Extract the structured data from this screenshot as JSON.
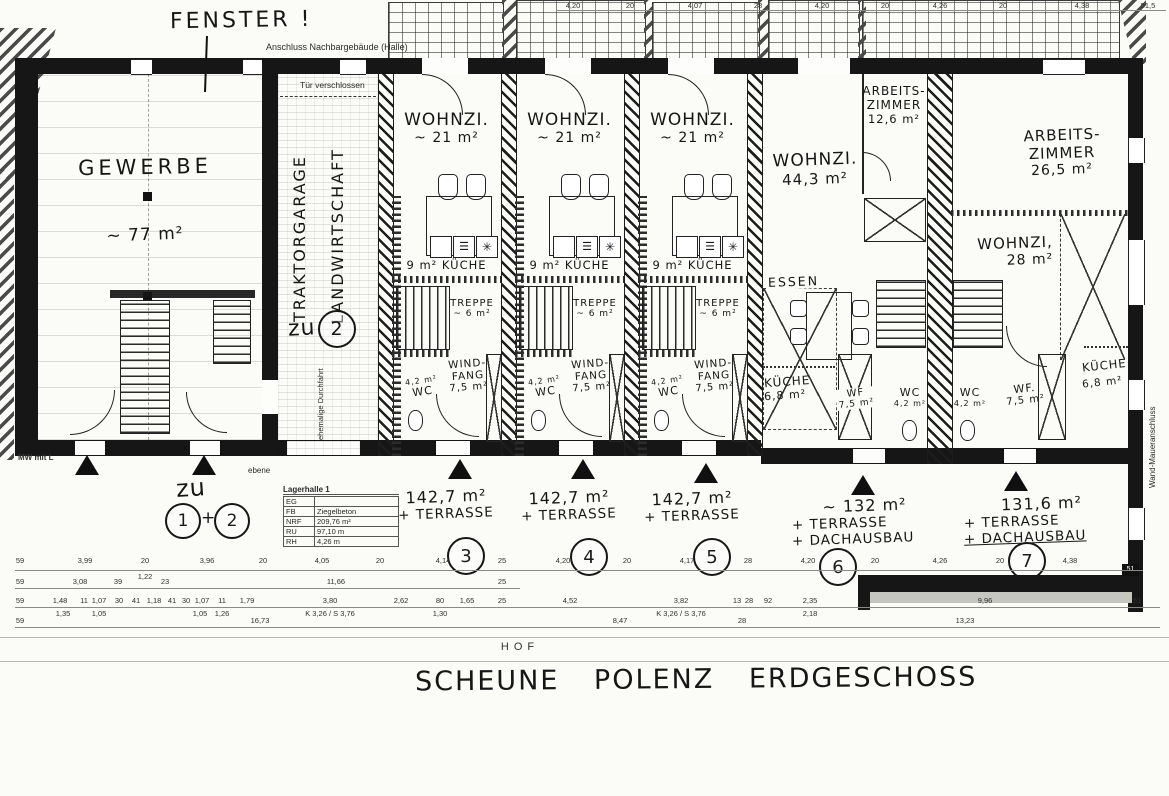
{
  "sheet": {
    "title": "SCHEUNE POLENZ ERDGESCHOSS",
    "hof": "HOF"
  },
  "notes": {
    "fenster": "FENSTER !",
    "anschluss": "Anschluss Nachbargebäude (Halle)",
    "tuer_verschlossen": "Tür verschlossen",
    "ehemalige_durchfahrt": "ehemalige Durchfahrt",
    "ebene": "ebene",
    "mw_mit_l": "MW mit L",
    "wand_maueranschluss": "Wand-Maueranschluss",
    "corner_51": "51"
  },
  "rooms": {
    "gewerbe": {
      "name": "GEWERBE",
      "area": "~ 77 m²"
    },
    "garage": {
      "line1": "TRAKTORGARAGE",
      "line2": "LANDWIRTSCHAFT",
      "zu": "zu",
      "zu_num": "2"
    },
    "rowhouse": {
      "wohnzi": "WOHNZI.",
      "wohnzi_area": "~ 21 m²",
      "kueche_area": "9 m²",
      "kueche": "KÜCHE",
      "treppe": "TREPPE",
      "treppe_area": "~ 6 m²",
      "wind": "WIND-",
      "fang": "FANG",
      "wf_area": "7,5 m²",
      "wc_area": "4,2 m²",
      "wc": "WC"
    },
    "unit6": {
      "wohnzi": "WOHNZI.",
      "wohnzi_area": "44,3 m²",
      "essen": "ESSEN",
      "kueche": "KÜCHE",
      "kueche_area": "6,8 m²",
      "az1": "ARBEITS-",
      "az2": "ZIMMER",
      "az_area": "12,6 m²",
      "wf": "WF",
      "wf_area": "7,5 m²",
      "wc": "WC",
      "wc_area": "4,2 m²"
    },
    "unit7": {
      "az1": "ARBEITS-",
      "az2": "ZIMMER",
      "az_area": "26,5 m²",
      "wohnzi": "WOHNZI,",
      "wohnzi_area": "28 m²",
      "wc": "WC",
      "wc_area": "4,2 m²",
      "wf": "WF.",
      "wf_area": "7,5 m²",
      "kueche": "KÜCHE",
      "kueche_area": "6,8 m²"
    }
  },
  "tags": {
    "entrance12": {
      "zu": "zu",
      "n1": "1",
      "plus": "+",
      "n2": "2"
    },
    "u3": {
      "area": "142,7 m²",
      "l2": "+ TERRASSE",
      "num": "3"
    },
    "u4": {
      "area": "142,7 m²",
      "l2": "+ TERRASSE",
      "num": "4"
    },
    "u5": {
      "area": "142,7 m²",
      "l2": "+ TERRASSE",
      "num": "5"
    },
    "u6": {
      "area": "~ 132  m²",
      "l2": "+ TERRASSE",
      "l3": "+ DACHAUSBAU",
      "num": "6"
    },
    "u7": {
      "area": "131,6 m²",
      "l2": "+ TERRASSE",
      "l3": "+ DACHAUSBAU",
      "num": "7"
    }
  },
  "lagerhalle": {
    "title": "Lagerhalle 1",
    "rows": [
      [
        "EG",
        ""
      ],
      [
        "FB",
        "Ziegelbeton"
      ],
      [
        "NRF",
        "209,76 m²"
      ],
      [
        "RU",
        "97,10 m"
      ],
      [
        "RH",
        "4,26 m"
      ]
    ]
  },
  "icons": {
    "stove": "✳",
    "oven": "☰"
  },
  "dims": {
    "lines": [
      {
        "y": 10,
        "x1": 556,
        "x2": 1166
      },
      {
        "y": 570,
        "x1": 15,
        "x2": 1143
      },
      {
        "y": 588,
        "x1": 15,
        "x2": 520
      },
      {
        "y": 607,
        "x1": 15,
        "x2": 1160
      },
      {
        "y": 627,
        "x1": 15,
        "x2": 1160
      }
    ],
    "groups": [
      {
        "y": 1,
        "items": [
          {
            "t": "4,20",
            "x": 573
          },
          {
            "t": "20",
            "x": 630
          },
          {
            "t": "4,07",
            "x": 695
          },
          {
            "t": "28",
            "x": 758
          },
          {
            "t": "4,20",
            "x": 822
          },
          {
            "t": "20",
            "x": 885
          },
          {
            "t": "4,26",
            "x": 940
          },
          {
            "t": "20",
            "x": 1003
          },
          {
            "t": "4,38",
            "x": 1082
          },
          {
            "t": "51,5",
            "x": 1148
          }
        ]
      },
      {
        "y": 556,
        "items": [
          {
            "t": "59",
            "x": 20
          },
          {
            "t": "3,99",
            "x": 85
          },
          {
            "t": "20",
            "x": 145
          },
          {
            "t": "3,96",
            "x": 207
          },
          {
            "t": "20",
            "x": 263
          },
          {
            "t": "4,05",
            "x": 322
          },
          {
            "t": "20",
            "x": 380
          },
          {
            "t": "4,14",
            "x": 443
          },
          {
            "t": "25",
            "x": 502
          },
          {
            "t": "4,20",
            "x": 563
          },
          {
            "t": "20",
            "x": 627
          },
          {
            "t": "4,17",
            "x": 687
          },
          {
            "t": "28",
            "x": 748
          },
          {
            "t": "4,20",
            "x": 808
          },
          {
            "t": "20",
            "x": 875
          },
          {
            "t": "4,26",
            "x": 940
          },
          {
            "t": "20",
            "x": 1000
          },
          {
            "t": "4,38",
            "x": 1070
          }
        ]
      },
      {
        "y": 572,
        "items": [
          {
            "t": "1,22",
            "x": 145
          }
        ]
      },
      {
        "y": 577,
        "items": [
          {
            "t": "59",
            "x": 20
          },
          {
            "t": "3,08",
            "x": 80
          },
          {
            "t": "39",
            "x": 118
          },
          {
            "t": "23",
            "x": 165
          },
          {
            "t": "11,66",
            "x": 336
          },
          {
            "t": "25",
            "x": 502
          }
        ]
      },
      {
        "y": 596,
        "items": [
          {
            "t": "59",
            "x": 20
          },
          {
            "t": "1,48",
            "x": 60
          },
          {
            "t": "11",
            "x": 84
          },
          {
            "t": "1,07",
            "x": 99
          },
          {
            "t": "30",
            "x": 119
          },
          {
            "t": "41",
            "x": 136
          },
          {
            "t": "1,18",
            "x": 154
          },
          {
            "t": "41",
            "x": 172
          },
          {
            "t": "30",
            "x": 186
          },
          {
            "t": "1,07",
            "x": 202
          },
          {
            "t": "11",
            "x": 222
          },
          {
            "t": "1,79",
            "x": 247
          },
          {
            "t": "3,80",
            "x": 330
          },
          {
            "t": "2,62",
            "x": 401
          },
          {
            "t": "80",
            "x": 440
          },
          {
            "t": "1,65",
            "x": 467
          },
          {
            "t": "25",
            "x": 502
          },
          {
            "t": "4,52",
            "x": 570
          },
          {
            "t": "3,82",
            "x": 681
          },
          {
            "t": "13",
            "x": 737
          },
          {
            "t": "28",
            "x": 749
          },
          {
            "t": "92",
            "x": 768
          },
          {
            "t": "2,35",
            "x": 810
          },
          {
            "t": "9,96",
            "x": 985
          },
          {
            "t": "51",
            "x": 1137
          }
        ]
      },
      {
        "y": 609,
        "items": [
          {
            "t": "1,35",
            "x": 63
          },
          {
            "t": "1,05",
            "x": 99
          },
          {
            "t": "1,05",
            "x": 200
          },
          {
            "t": "1,26",
            "x": 222
          },
          {
            "t": "K 3,26 / S 3,76",
            "x": 330
          },
          {
            "t": "1,30",
            "x": 440
          },
          {
            "t": "K 3,26 / S 3,76",
            "x": 681
          },
          {
            "t": "2,18",
            "x": 810
          }
        ]
      },
      {
        "y": 616,
        "items": [
          {
            "t": "59",
            "x": 20
          },
          {
            "t": "16,73",
            "x": 260
          },
          {
            "t": "8,47",
            "x": 620
          },
          {
            "t": "28",
            "x": 742
          },
          {
            "t": "13,23",
            "x": 965
          }
        ]
      }
    ]
  }
}
